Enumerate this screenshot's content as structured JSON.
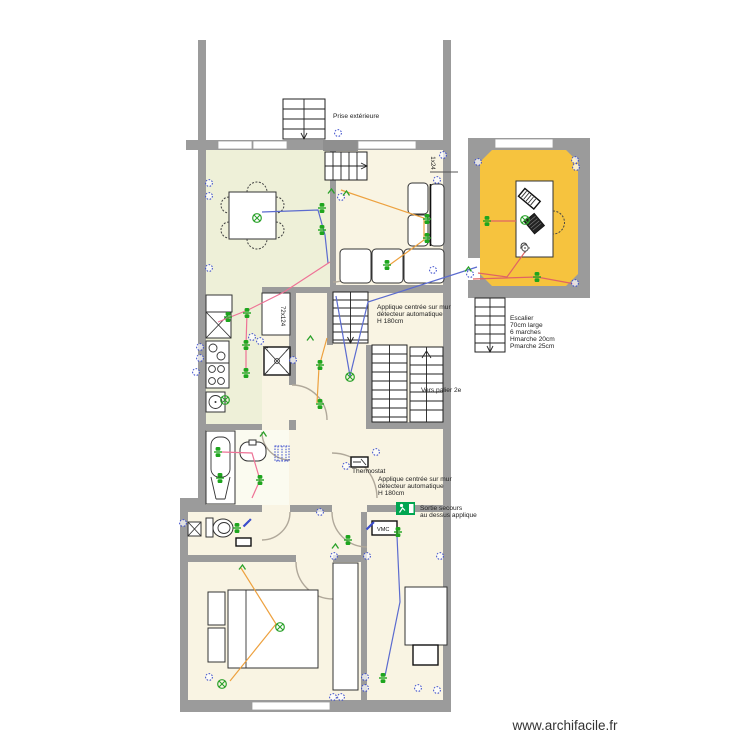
{
  "labels": {
    "prise_exterieure": "Prise extérieure",
    "applique_note": [
      "Applique centrée sur mur",
      "détecteur automatique",
      "H 180cm"
    ],
    "escalier_note": [
      "Escalier",
      "70cm large",
      "6 marches",
      "Hmarche 20cm",
      "Pmarche 25cm"
    ],
    "vers_palier": "Vers palier 2e",
    "thermostat": "Thermostat",
    "sortie_secours": [
      "Sortie secours",
      "au dessus applique"
    ],
    "vmc": "VMC",
    "closet_dim": "72x124",
    "window_dim": "1x24",
    "watermark": "www.archifacile.fr"
  },
  "colors": {
    "wall": "#9b9b9b",
    "living_room": "#eef0d8",
    "cream_room": "#f9f4e3",
    "bathroom": "#fbfbf0",
    "annex_room": "#f6c33e",
    "outlet": "#3a4ccc",
    "switch": "#1ea51e",
    "light": "#2aa12a",
    "exit_sign": "#00a651",
    "wire_blue": "#5b6bcf",
    "wire_orange": "#eda13f",
    "wire_pink": "#ee7296",
    "wire_red": "#e06464"
  },
  "symbols": [
    {
      "type": "outlet",
      "x": 209,
      "y": 183
    },
    {
      "type": "outlet",
      "x": 209,
      "y": 196
    },
    {
      "type": "outlet",
      "x": 209,
      "y": 268
    },
    {
      "type": "outlet",
      "x": 338,
      "y": 133
    },
    {
      "type": "outlet",
      "x": 443,
      "y": 155
    },
    {
      "type": "outlet",
      "x": 437,
      "y": 180
    },
    {
      "type": "outlet",
      "x": 433,
      "y": 270
    },
    {
      "type": "outlet",
      "x": 341,
      "y": 197
    },
    {
      "type": "outlet",
      "x": 200,
      "y": 347
    },
    {
      "type": "outlet",
      "x": 200,
      "y": 358
    },
    {
      "type": "outlet",
      "x": 196,
      "y": 372
    },
    {
      "type": "outlet",
      "x": 252,
      "y": 337
    },
    {
      "type": "outlet",
      "x": 260,
      "y": 341
    },
    {
      "type": "outlet",
      "x": 293,
      "y": 360
    },
    {
      "type": "outlet",
      "x": 376,
      "y": 452
    },
    {
      "type": "outlet",
      "x": 346,
      "y": 466
    },
    {
      "type": "outlet",
      "x": 183,
      "y": 523
    },
    {
      "type": "outlet",
      "x": 320,
      "y": 512
    },
    {
      "type": "outlet",
      "x": 334,
      "y": 556
    },
    {
      "type": "outlet",
      "x": 367,
      "y": 556
    },
    {
      "type": "outlet",
      "x": 440,
      "y": 556
    },
    {
      "type": "outlet",
      "x": 209,
      "y": 677
    },
    {
      "type": "outlet",
      "x": 333,
      "y": 697
    },
    {
      "type": "outlet",
      "x": 341,
      "y": 697
    },
    {
      "type": "outlet",
      "x": 418,
      "y": 688
    },
    {
      "type": "outlet",
      "x": 437,
      "y": 690
    },
    {
      "type": "outlet",
      "x": 365,
      "y": 677
    },
    {
      "type": "outlet",
      "x": 365,
      "y": 688
    },
    {
      "type": "outlet",
      "x": 478,
      "y": 162
    },
    {
      "type": "outlet",
      "x": 575,
      "y": 160
    },
    {
      "type": "outlet",
      "x": 576,
      "y": 167
    },
    {
      "type": "outlet",
      "x": 470,
      "y": 274
    },
    {
      "type": "outlet",
      "x": 575,
      "y": 283
    },
    {
      "type": "switch",
      "x": 322,
      "y": 208
    },
    {
      "type": "switch",
      "x": 322,
      "y": 230
    },
    {
      "type": "switch",
      "x": 427,
      "y": 219
    },
    {
      "type": "switch",
      "x": 427,
      "y": 238
    },
    {
      "type": "switch",
      "x": 387,
      "y": 265
    },
    {
      "type": "switch",
      "x": 228,
      "y": 317
    },
    {
      "type": "switch",
      "x": 247,
      "y": 313
    },
    {
      "type": "switch",
      "x": 246,
      "y": 345
    },
    {
      "type": "switch",
      "x": 246,
      "y": 373
    },
    {
      "type": "switch",
      "x": 218,
      "y": 452
    },
    {
      "type": "switch",
      "x": 220,
      "y": 478
    },
    {
      "type": "switch",
      "x": 260,
      "y": 480
    },
    {
      "type": "switch",
      "x": 237,
      "y": 528
    },
    {
      "type": "switch",
      "x": 348,
      "y": 540
    },
    {
      "type": "switch",
      "x": 398,
      "y": 532
    },
    {
      "type": "switch",
      "x": 383,
      "y": 678
    },
    {
      "type": "switch",
      "x": 320,
      "y": 365
    },
    {
      "type": "switch",
      "x": 320,
      "y": 404
    },
    {
      "type": "switch",
      "x": 487,
      "y": 221
    },
    {
      "type": "switch",
      "x": 537,
      "y": 277
    },
    {
      "type": "light",
      "x": 257,
      "y": 218
    },
    {
      "type": "light",
      "x": 225,
      "y": 400
    },
    {
      "type": "light",
      "x": 350,
      "y": 377
    },
    {
      "type": "light",
      "x": 280,
      "y": 627
    },
    {
      "type": "light",
      "x": 222,
      "y": 684
    },
    {
      "type": "light",
      "x": 525,
      "y": 220
    },
    {
      "type": "applique",
      "x": 331,
      "y": 191
    },
    {
      "type": "applique",
      "x": 346,
      "y": 193
    },
    {
      "type": "applique",
      "x": 310,
      "y": 338
    },
    {
      "type": "applique",
      "x": 468,
      "y": 269
    },
    {
      "type": "applique",
      "x": 335,
      "y": 546
    },
    {
      "type": "applique",
      "x": 242,
      "y": 567
    },
    {
      "type": "applique",
      "x": 263,
      "y": 434
    },
    {
      "type": "pen",
      "x": 247,
      "y": 523
    },
    {
      "type": "pen",
      "x": 370,
      "y": 526
    },
    {
      "type": "lamp",
      "x": 525,
      "y": 248
    }
  ],
  "wires": [
    {
      "name": "wire-living-light",
      "color_key": "wire_blue",
      "points": [
        [
          262,
          212
        ],
        [
          318,
          210
        ],
        [
          325,
          235
        ],
        [
          328,
          263
        ]
      ]
    },
    {
      "name": "wire-annex-stairs",
      "color_key": "wire_blue",
      "points": [
        [
          477,
          267
        ],
        [
          368,
          302
        ],
        [
          350,
          376
        ]
      ]
    },
    {
      "name": "wire-stair-switch",
      "color_key": "wire_blue",
      "points": [
        [
          336,
          296
        ],
        [
          350,
          376
        ]
      ]
    },
    {
      "name": "wire-bedroom-right",
      "color_key": "wire_blue",
      "points": [
        [
          397,
          536
        ],
        [
          400,
          602
        ],
        [
          385,
          676
        ]
      ]
    },
    {
      "name": "wire-bedroom-top",
      "color_key": "wire_orange",
      "points": [
        [
          341,
          190
        ],
        [
          424,
          218
        ],
        [
          424,
          240
        ],
        [
          388,
          266
        ]
      ]
    },
    {
      "name": "wire-bedroom-left",
      "color_key": "wire_orange",
      "points": [
        [
          241,
          568
        ],
        [
          276,
          624
        ],
        [
          230,
          681
        ]
      ]
    },
    {
      "name": "wire-corridor",
      "color_key": "wire_orange",
      "points": [
        [
          327,
          338
        ],
        [
          319,
          367
        ],
        [
          317,
          403
        ]
      ]
    },
    {
      "name": "wire-kitchen-1",
      "color_key": "wire_pink",
      "points": [
        [
          330,
          262
        ],
        [
          284,
          292
        ],
        [
          248,
          310
        ],
        [
          218,
          322
        ]
      ]
    },
    {
      "name": "wire-kitchen-2",
      "color_key": "wire_pink",
      "points": [
        [
          247,
          313
        ],
        [
          246,
          345
        ],
        [
          246,
          373
        ]
      ]
    },
    {
      "name": "wire-bathroom",
      "color_key": "wire_pink",
      "points": [
        [
          222,
          452
        ],
        [
          252,
          453
        ],
        [
          260,
          480
        ],
        [
          252,
          498
        ]
      ]
    },
    {
      "name": "wire-annex-desk",
      "color_key": "wire_red",
      "points": [
        [
          490,
          221
        ],
        [
          516,
          221
        ]
      ]
    },
    {
      "name": "wire-annex-lamp",
      "color_key": "wire_red",
      "points": [
        [
          527,
          249
        ],
        [
          507,
          277
        ],
        [
          478,
          273
        ]
      ]
    },
    {
      "name": "wire-annex-bottom",
      "color_key": "wire_red",
      "points": [
        [
          473,
          279
        ],
        [
          537,
          277
        ],
        [
          575,
          284
        ]
      ]
    }
  ]
}
